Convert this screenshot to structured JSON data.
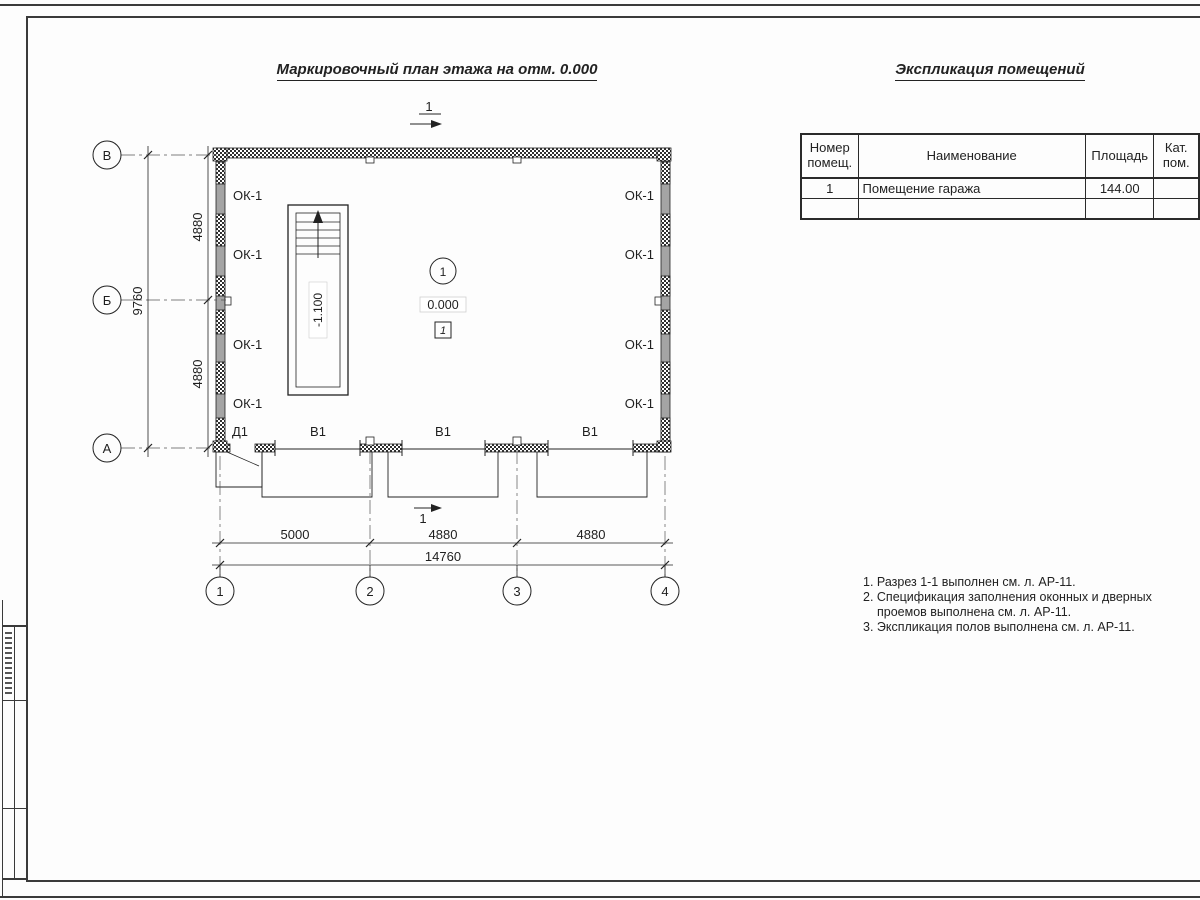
{
  "titles": {
    "plan_title": "Маркировочный план этажа на отм. 0.000",
    "schedule_title": "Экспликация помещений"
  },
  "plan": {
    "grid_rows": [
      "В",
      "Б",
      "А"
    ],
    "grid_cols": [
      "1",
      "2",
      "3",
      "4"
    ],
    "dims_left": {
      "seg1": "4880",
      "seg2": "4880",
      "total": "9760"
    },
    "dims_bottom": {
      "seg1": "5000",
      "seg2": "4880",
      "seg3": "4880",
      "total": "14760"
    },
    "window_mark": "ОК-1",
    "door_mark": "Д1",
    "gate_mark": "В1",
    "room_number": "1",
    "floor_elevation": "0.000",
    "floor_type_mark": "1",
    "pit_elevation": "-1.100",
    "section_mark": "1"
  },
  "schedule": {
    "headers": {
      "number": "Номер\nпомещ.",
      "name": "Наименование",
      "area": "Площадь",
      "cat": "Кат.\nпом."
    },
    "rows": [
      {
        "number": "1",
        "name": "Помещение гаража",
        "area": "144.00",
        "cat": ""
      },
      {
        "number": "",
        "name": "",
        "area": "",
        "cat": ""
      }
    ]
  },
  "notes": {
    "line1": "1. Разрез 1-1 выполнен см. л. АР-11.",
    "line2": "2. Спецификация заполнения оконных и дверных",
    "line3": "проемов выполнена см. л. АР-11.",
    "line4": "3. Экспликация полов выполнена см. л. АР-11."
  }
}
